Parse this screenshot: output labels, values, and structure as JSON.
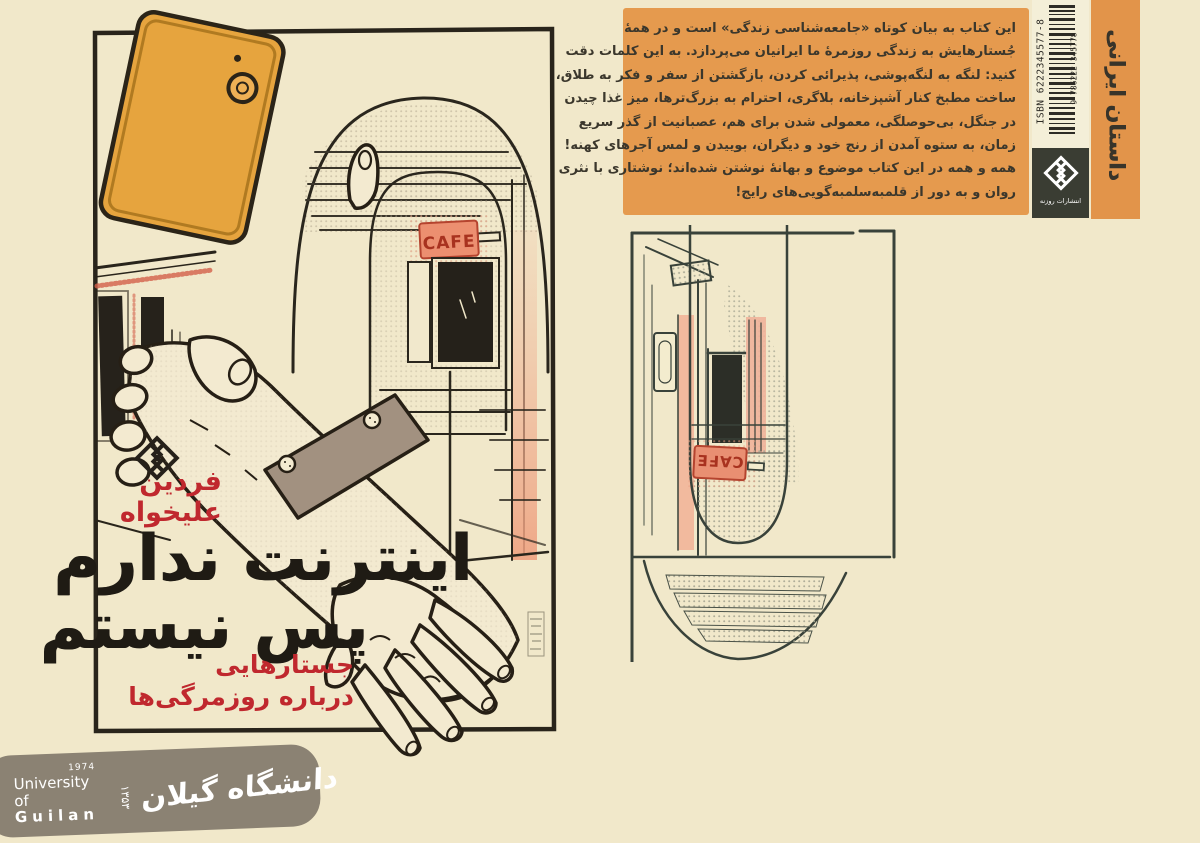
{
  "page": {
    "background": "#f1e8ca"
  },
  "front_cover": {
    "author": {
      "line1": "فردین",
      "line2": "علیخواه"
    },
    "title": {
      "line1": "اینترنت ندارم",
      "line2": "پس نیستم"
    },
    "subtitle": {
      "line1": "جستارهایی",
      "line2": "درباره روزمرگی‌ها"
    },
    "cafe_sign": "CAFE",
    "colors": {
      "title_ink": "#1f1b14",
      "accent_red": "#c0282e",
      "phone_orange": "#e6a43e",
      "cuff_gray": "#a29180",
      "salmon": "#f0ab8e",
      "paper": "#f1e8ca"
    }
  },
  "back_cover": {
    "blurb_lines": [
      "این کتاب به بیان کوتاه «جامعه‌شناسی زندگی» است و در همهٔ",
      "جُستارهایش به زندگی روزمرهٔ ما ایرانیان می‌پردازد. به این کلمات دقت",
      "کنید: لنگه به لنگه‌پوشی، پذیرائی کردن، بازگشتن از سفر و فکر به طلاق،",
      "ساخت مطبخ کنار آشپزخانه، بلاگری، احترام به بزرگ‌ترها، میز غذا چیدن",
      "در جنگل، بی‌حوصلگی، معمولی شدن برای هم، عصبانیت از گذر سریع",
      "زمان، به ستوه آمدن از رنج خود و دیگران، بوییدن و لمس آجرهای کهنه!",
      "همه و همه در این کتاب موضوع و بهانهٔ نوشتن شده‌اند؛ نوشتاری با نثری",
      "روان و به دور از قلمبه‌سلمبه‌گویی‌های رایج!"
    ],
    "genre_label": "داستان ایرانی",
    "isbn_text": "ISBN 6222345577-8",
    "barcode_number": "9 786222 345778",
    "publisher_name": "انتشارات روزنه",
    "cafe_sign": "CAFE",
    "colors": {
      "blurb_bg": "#e59a4e",
      "blurb_text": "#3b372c",
      "strip_bg": "#e2944a",
      "publisher_box": "#3a3d33",
      "barcode_bg": "#f4efd8"
    }
  },
  "footer_logo": {
    "year_en": "1974",
    "name_en_line1": "University of",
    "name_en_line2": "Guilan",
    "year_fa": "۱۳۵۳",
    "name_fa": "دانشگاه گیلان",
    "colors": {
      "banner": "#8b8273",
      "text": "#ffffff"
    }
  }
}
